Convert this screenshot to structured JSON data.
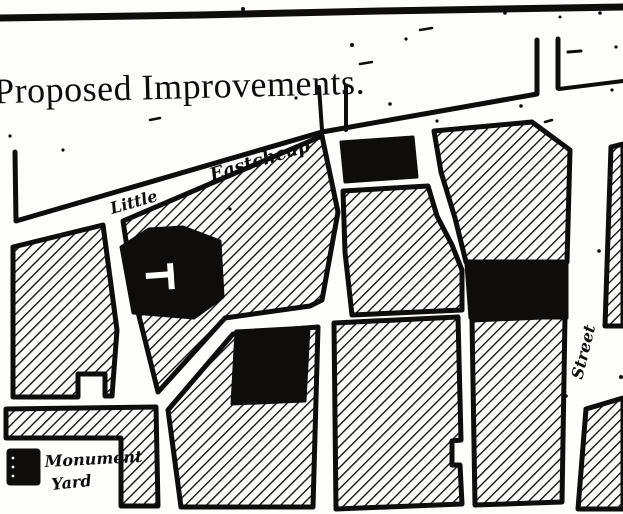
{
  "map": {
    "title": "Proposed Improvements.",
    "street_labels": {
      "little": "Little",
      "eastcheap": "Eastcheap",
      "street_vertical": "Street"
    },
    "legend": {
      "line1": "Monument",
      "line2": "Yard"
    },
    "colors": {
      "ink": "#0e0d0b",
      "paper": "#fdfdfa"
    }
  }
}
